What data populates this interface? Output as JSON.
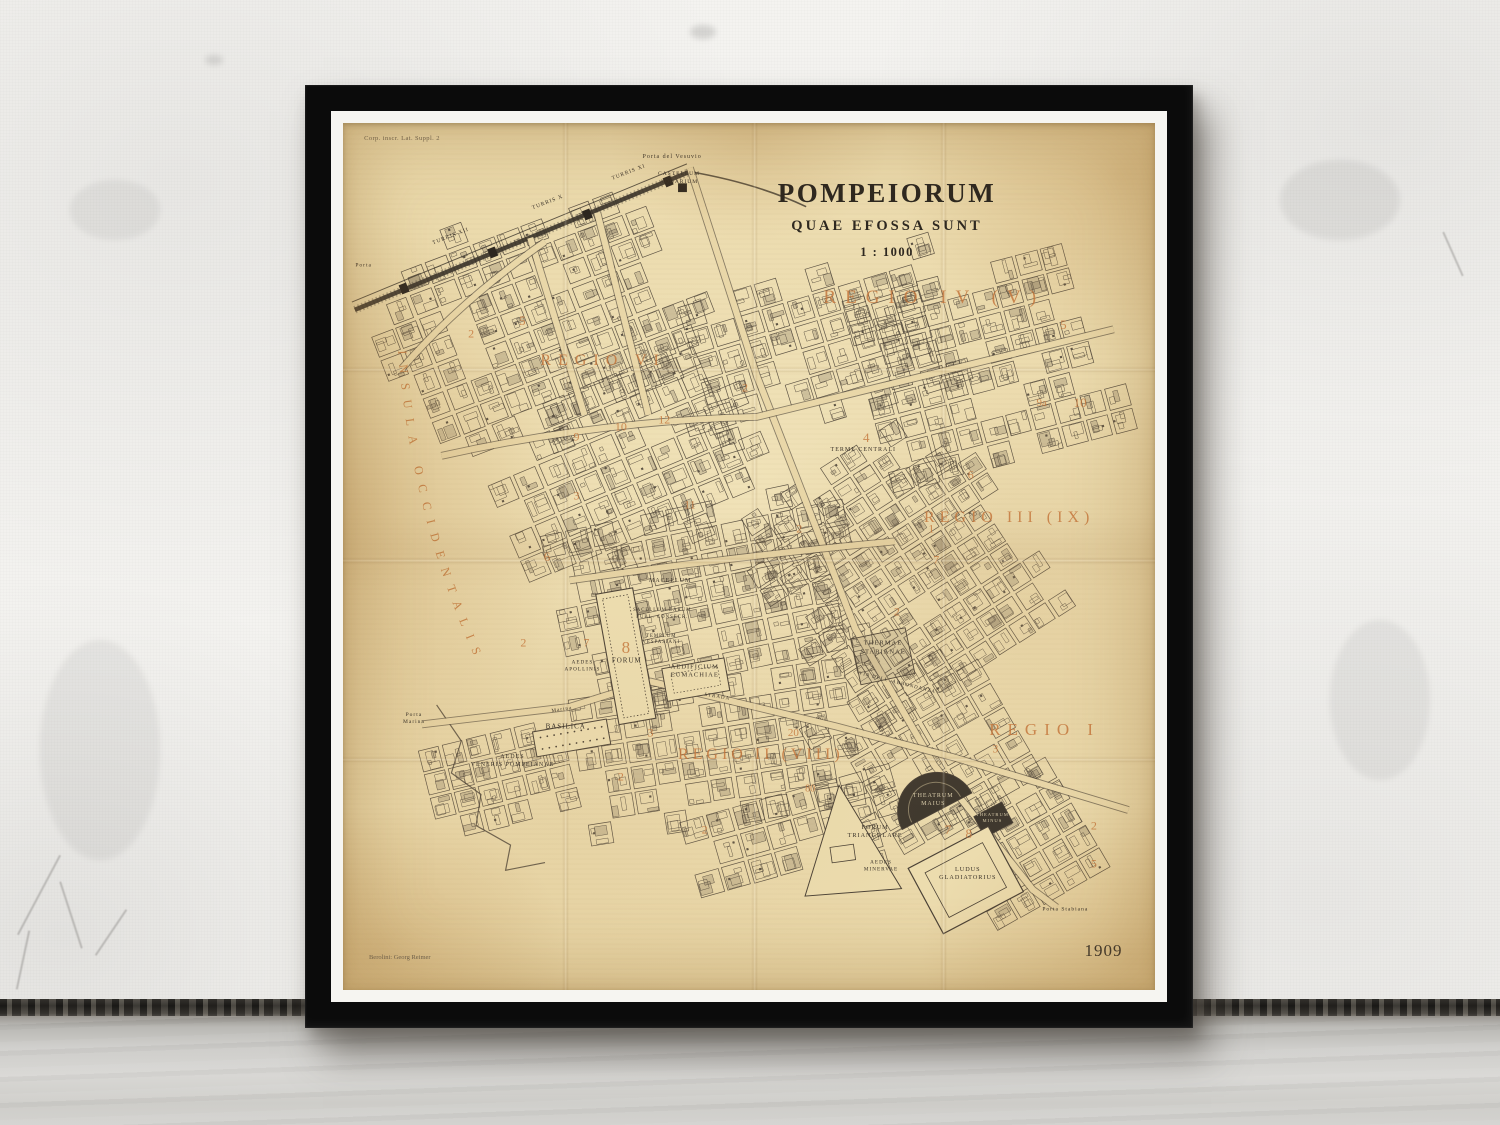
{
  "map": {
    "title": "POMPEIORUM",
    "subtitle": "QUAE EFOSSA SUNT",
    "scale_text": "1 : 1000",
    "year": "1909",
    "imprint": "Berolini: Georg Reimer",
    "plate_note": "Corp. inscr. Lat. Suppl. 2",
    "west_edge_label": "INSULA OCCIDENTALIS",
    "colors": {
      "paper": "#e9d7a8",
      "ink": "#4a4136",
      "accent": "#c4753a",
      "dark_fill": "#3f382e"
    },
    "region_labels": [
      {
        "text": "REGIO VI",
        "x": 264,
        "y": 245,
        "size": 16,
        "spacing": 7
      },
      {
        "text": "REGIO IV (V)",
        "x": 600,
        "y": 180,
        "size": 19,
        "spacing": 9
      },
      {
        "text": "REGIO III (IX)",
        "x": 676,
        "y": 406,
        "size": 16,
        "spacing": 5
      },
      {
        "text": "REGIO I",
        "x": 712,
        "y": 624,
        "size": 17,
        "spacing": 7
      },
      {
        "text": "REGIO II (VIII)",
        "x": 424,
        "y": 650,
        "size": 16,
        "spacing": 4
      }
    ],
    "place_labels": [
      {
        "text": "Porta del Vesuvio",
        "x": 334,
        "y": 36,
        "size": 6
      },
      {
        "text": "CASTELLUM\nAQUARIUM",
        "x": 341,
        "y": 57,
        "size": 5.5
      },
      {
        "text": "TURRIS XI",
        "x": 290,
        "y": 51,
        "size": 5.5,
        "rotate": -21
      },
      {
        "text": "TURRIS X",
        "x": 208,
        "y": 82,
        "size": 5.5,
        "rotate": -21
      },
      {
        "text": "TURRIS XII",
        "x": 110,
        "y": 117,
        "size": 5.5,
        "rotate": -21
      },
      {
        "text": "Porta",
        "x": 21,
        "y": 147,
        "size": 5.5
      },
      {
        "text": "TERME CENTRALI",
        "x": 528,
        "y": 337,
        "size": 6
      },
      {
        "text": "THERMAE\nSTABIANAE",
        "x": 548,
        "y": 540,
        "size": 6.5
      },
      {
        "text": "MACELLUM",
        "x": 332,
        "y": 472,
        "size": 6
      },
      {
        "text": "SACELLUM LARUM\nPUBL. CONSECR.",
        "x": 324,
        "y": 505,
        "size": 4.8
      },
      {
        "text": "TEMPLUM\nVESPASIANI",
        "x": 323,
        "y": 531,
        "size": 4.8
      },
      {
        "text": "AEDIFICIUM\nEUMACHIAE",
        "x": 357,
        "y": 564,
        "size": 6.5
      },
      {
        "text": "AEDES\nAPOLLINIS",
        "x": 243,
        "y": 558,
        "size": 5.2
      },
      {
        "text": "FORUM",
        "x": 288,
        "y": 553,
        "size": 7
      },
      {
        "text": "BASILICA",
        "x": 226,
        "y": 621,
        "size": 7
      },
      {
        "text": "Marina",
        "x": 222,
        "y": 603,
        "size": 5.2,
        "rotate": -9
      },
      {
        "text": "Porta\nMarina",
        "x": 72,
        "y": 612,
        "size": 5.5
      },
      {
        "text": "AEDES\nVENERIS POMPEIANAE",
        "x": 172,
        "y": 657,
        "size": 6
      },
      {
        "text": "VIA DELL' ABBONDANZA",
        "x": 562,
        "y": 577,
        "size": 5,
        "rotate": 14
      },
      {
        "text": "STRADA",
        "x": 380,
        "y": 591,
        "size": 5,
        "rotate": 9
      },
      {
        "text": "FORUM\nTRIANGULARE",
        "x": 540,
        "y": 729,
        "size": 6.2
      },
      {
        "text": "AEDES\nMINERVAE",
        "x": 546,
        "y": 764,
        "size": 5.2
      },
      {
        "text": "THEATRUM\nMAIUS",
        "x": 599,
        "y": 697,
        "size": 6,
        "light": true
      },
      {
        "text": "THEATRUM\nMINUS",
        "x": 659,
        "y": 714,
        "size": 4.6,
        "light": true
      },
      {
        "text": "LUDUS\nGLADIATORIUS",
        "x": 634,
        "y": 772,
        "size": 6.2
      },
      {
        "text": "Porta Stabiana",
        "x": 733,
        "y": 809,
        "size": 5.5
      }
    ],
    "insula_numbers": [
      {
        "n": "5",
        "x": 182,
        "y": 203,
        "s": 13
      },
      {
        "n": "2",
        "x": 130,
        "y": 217,
        "s": 12
      },
      {
        "n": "9",
        "x": 237,
        "y": 323,
        "s": 12
      },
      {
        "n": "10",
        "x": 282,
        "y": 312,
        "s": 12
      },
      {
        "n": "12",
        "x": 326,
        "y": 305,
        "s": 12
      },
      {
        "n": "2",
        "x": 408,
        "y": 272,
        "s": 12
      },
      {
        "n": "3",
        "x": 237,
        "y": 383,
        "s": 12
      },
      {
        "n": "11",
        "x": 352,
        "y": 393,
        "s": 12
      },
      {
        "n": "2",
        "x": 463,
        "y": 417,
        "s": 12
      },
      {
        "n": "6",
        "x": 207,
        "y": 446,
        "s": 13
      },
      {
        "n": "7",
        "x": 247,
        "y": 534,
        "s": 12
      },
      {
        "n": "2",
        "x": 183,
        "y": 534,
        "s": 12
      },
      {
        "n": "8",
        "x": 287,
        "y": 540,
        "s": 17
      },
      {
        "n": "4",
        "x": 531,
        "y": 324,
        "s": 13
      },
      {
        "n": "6",
        "x": 637,
        "y": 362,
        "s": 12
      },
      {
        "n": "1",
        "x": 597,
        "y": 417,
        "s": 12
      },
      {
        "n": "7",
        "x": 602,
        "y": 449,
        "s": 12
      },
      {
        "n": "5",
        "x": 731,
        "y": 208,
        "s": 13
      },
      {
        "n": "9a",
        "x": 709,
        "y": 288,
        "s": 11
      },
      {
        "n": "10",
        "x": 748,
        "y": 288,
        "s": 13
      },
      {
        "n": "2",
        "x": 562,
        "y": 503,
        "s": 12
      },
      {
        "n": "20",
        "x": 457,
        "y": 627,
        "s": 11
      },
      {
        "n": "3",
        "x": 312,
        "y": 627,
        "s": 12
      },
      {
        "n": "2",
        "x": 282,
        "y": 672,
        "s": 12
      },
      {
        "n": "2",
        "x": 367,
        "y": 727,
        "s": 12
      },
      {
        "n": "7",
        "x": 614,
        "y": 727,
        "s": 13
      },
      {
        "n": "8",
        "x": 635,
        "y": 731,
        "s": 13
      },
      {
        "n": "2",
        "x": 762,
        "y": 722,
        "s": 12
      },
      {
        "n": "5",
        "x": 762,
        "y": 762,
        "s": 12
      },
      {
        "n": "3",
        "x": 662,
        "y": 643,
        "s": 12
      },
      {
        "n": "80",
        "x": 474,
        "y": 684,
        "s": 10
      }
    ]
  }
}
